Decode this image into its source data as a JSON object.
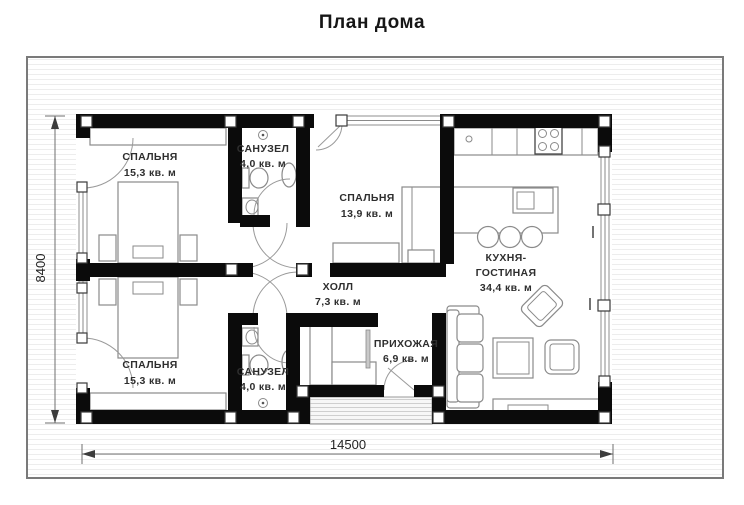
{
  "title": "План дома",
  "rooms": {
    "bedroom_top": {
      "name": "СПАЛЬНЯ",
      "area": "15,3 кв. м"
    },
    "bathroom_top": {
      "name": "САНУЗЕЛ",
      "area": "4,0 кв. м"
    },
    "bedroom_mid": {
      "name": "СПАЛЬНЯ",
      "area": "13,9 кв. м"
    },
    "kitchen_living": {
      "name_line1": "КУХНЯ-",
      "name_line2": "ГОСТИНАЯ",
      "area": "34,4 кв. м"
    },
    "hall": {
      "name": "ХОЛЛ",
      "area": "7,3 кв. м"
    },
    "entry": {
      "name": "ПРИХОЖАЯ",
      "area": "6,9 кв. м"
    },
    "bedroom_bottom": {
      "name": "СПАЛЬНЯ",
      "area": "15,3 кв. м"
    },
    "bathroom_bottom": {
      "name": "САНУЗЕЛ",
      "area": "4,0 кв. м"
    }
  },
  "dimensions": {
    "total_width_mm": "14500",
    "total_height_mm": "8400"
  },
  "colors": {
    "wall": "#0b0b0b",
    "furniture_line": "#8a8a8a",
    "text": "#2e2e2e",
    "frame": "#7a7a7a",
    "stripe": "#ededed"
  }
}
